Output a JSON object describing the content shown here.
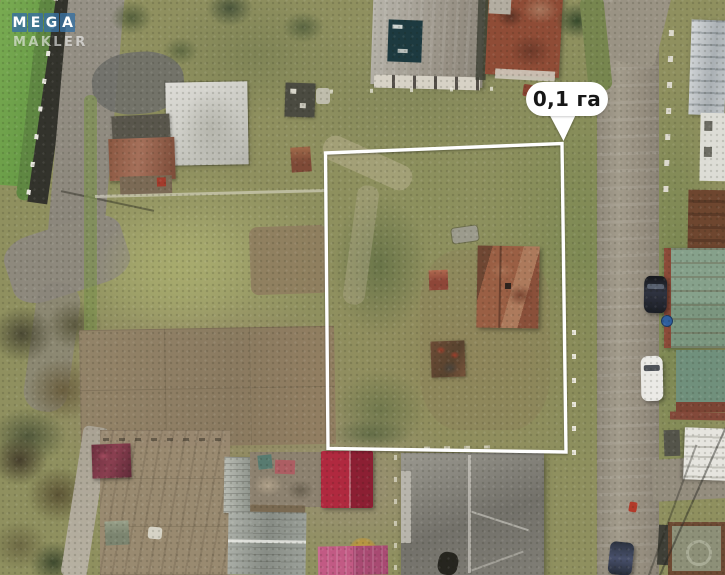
{
  "watermark": {
    "mega_letters": [
      "M",
      "E",
      "G",
      "A"
    ],
    "subtitle": "MAKLER",
    "tile_color": "#3870a0",
    "text_color": "#ffffff"
  },
  "plot": {
    "area_label": "0,1 га",
    "outline_color": "#ffffff",
    "bubble_bg": "#ffffff",
    "bubble_text_color": "#171717"
  },
  "scene": {
    "type": "aerial-drone-photo",
    "subject": "suburban land plot outlined in white with houses, gardens and roads around it"
  }
}
